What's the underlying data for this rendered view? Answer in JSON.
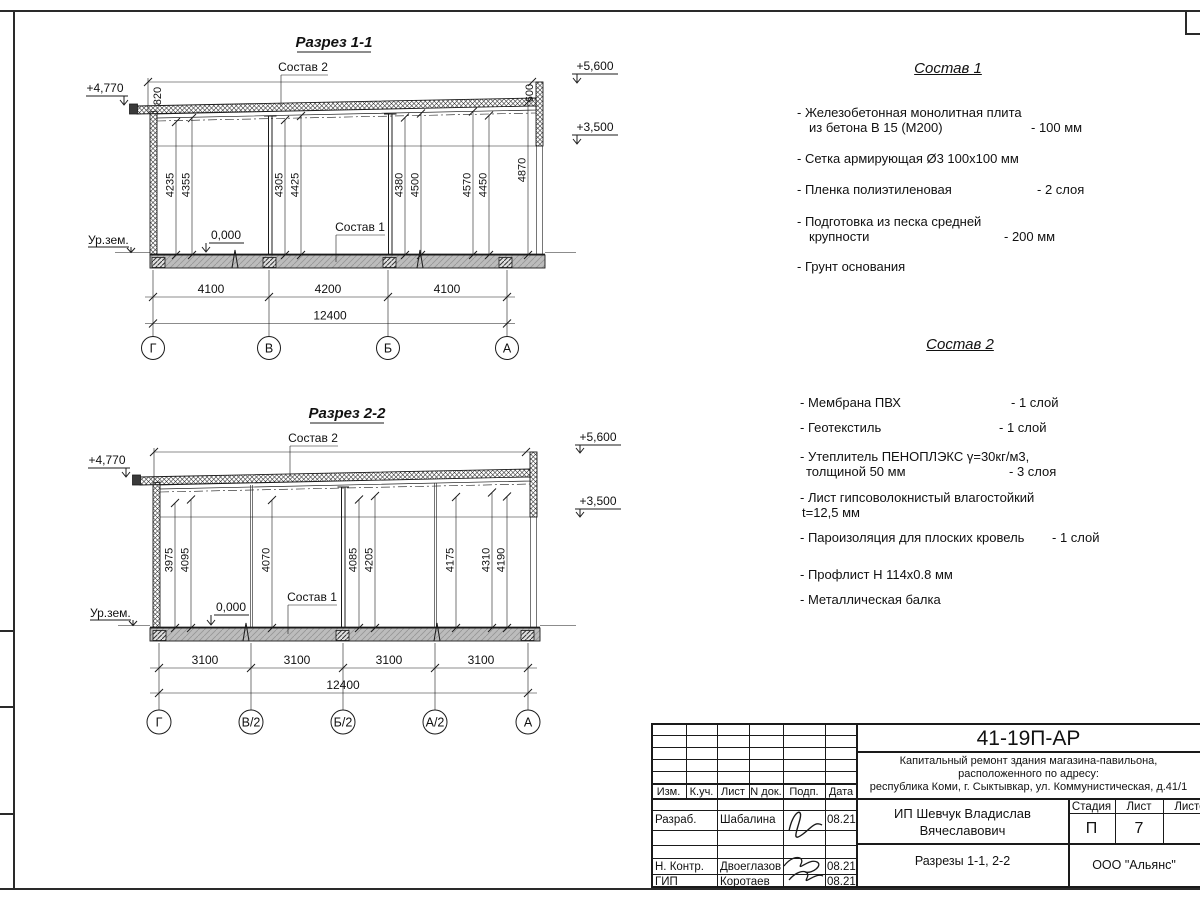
{
  "s1": {
    "title": "Разрез 1-1",
    "callout_roof": "Состав 2",
    "callout_floor": "Состав 1",
    "elev_left": "+4,770",
    "elev_parapet": "+5,600",
    "elev_ceiling": "+3,500",
    "elev_zero": "0,000",
    "ground": "Ур.зем.",
    "dim_left_v": "820",
    "dim_right_v": "600",
    "vdims": [
      "4235",
      "4355",
      "4305",
      "4425",
      "4380",
      "4500",
      "4570",
      "4450",
      "4870"
    ],
    "bdims": [
      "4100",
      "4200",
      "4100"
    ],
    "total": "12400",
    "axes": [
      "Г",
      "В",
      "Б",
      "А"
    ]
  },
  "s2": {
    "title": "Разрез 2-2",
    "callout_roof": "Состав 2",
    "callout_floor": "Состав 1",
    "elev_left": "+4,770",
    "elev_parapet": "+5,600",
    "elev_ceiling": "+3,500",
    "elev_zero": "0,000",
    "ground": "Ур.зем.",
    "vdims": [
      "3975",
      "4095",
      "4070",
      "4085",
      "4205",
      "4175",
      "4310",
      "4190"
    ],
    "bdims": [
      "3100",
      "3100",
      "3100",
      "3100"
    ],
    "total": "12400",
    "axes": [
      "Г",
      "В/2",
      "Б/2",
      "А/2",
      "А"
    ]
  },
  "sostav1": {
    "title": "Состав 1",
    "items": [
      {
        "l1": "- Железобетонная  монолитная плита",
        "l2": "из бетона В 15 (М200)",
        "val": "- 100 мм"
      },
      {
        "l1": "- Сетка армирующая Ø3 100x100 мм"
      },
      {
        "l1": "- Пленка полиэтиленовая",
        "val": "- 2 слоя"
      },
      {
        "l1": "- Подготовка из песка средней",
        "l2": "крупности",
        "val": "- 200 мм"
      },
      {
        "l1": "- Грунт основания"
      }
    ]
  },
  "sostav2": {
    "title": "Состав 2",
    "items": [
      {
        "l1": "- Мембрана ПВХ",
        "val": "- 1 слой"
      },
      {
        "l1": "- Геотекстиль",
        "val": "- 1 слой"
      },
      {
        "l1": "- Утеплитель ПЕНОПЛЭКС γ=30кг/м3,",
        "l2": "толщиной 50 мм",
        "val": "- 3 слоя"
      },
      {
        "l1": "- Лист гипсоволокнистый влагостойкий",
        "l2": "t=12,5 мм"
      },
      {
        "l1": "- Пароизоляция для плоских кровель",
        "val": "- 1 слой"
      },
      {
        "l1": "- Профлист Н 114x0.8 мм"
      },
      {
        "l1": "- Металлическая балка"
      }
    ]
  },
  "tb": {
    "doc_number": "41-19П-АР",
    "desc1": "Капитальный ремонт здания магазина-павильона,",
    "desc2": "расположенного по адресу:",
    "desc3": "республика Коми, г. Сыктывкар, ул. Коммунистическая, д.41/1",
    "client1": "ИП Шевчук Владислав",
    "client2": "Вячеславович",
    "sheet_title": "Разрезы 1-1, 2-2",
    "org": "ООО \"Альянс\"",
    "cols": {
      "izm": "Изм.",
      "kuch": "К.уч.",
      "list": "Лист",
      "ndok": "N док.",
      "podp": "Подп.",
      "data": "Дата"
    },
    "stage_label": "Стадия",
    "sheet_label": "Лист",
    "sheets_label": "Листов",
    "stage": "П",
    "sheet_num": "7",
    "rows": [
      {
        "role": "Разраб.",
        "name": "Шабалина",
        "date": "08.21"
      },
      {
        "role": "Н. Контр.",
        "name": "Двоеглазов",
        "date": "08.21"
      },
      {
        "role": "ГИП",
        "name": "Коротаев",
        "date": "08.21"
      }
    ]
  }
}
